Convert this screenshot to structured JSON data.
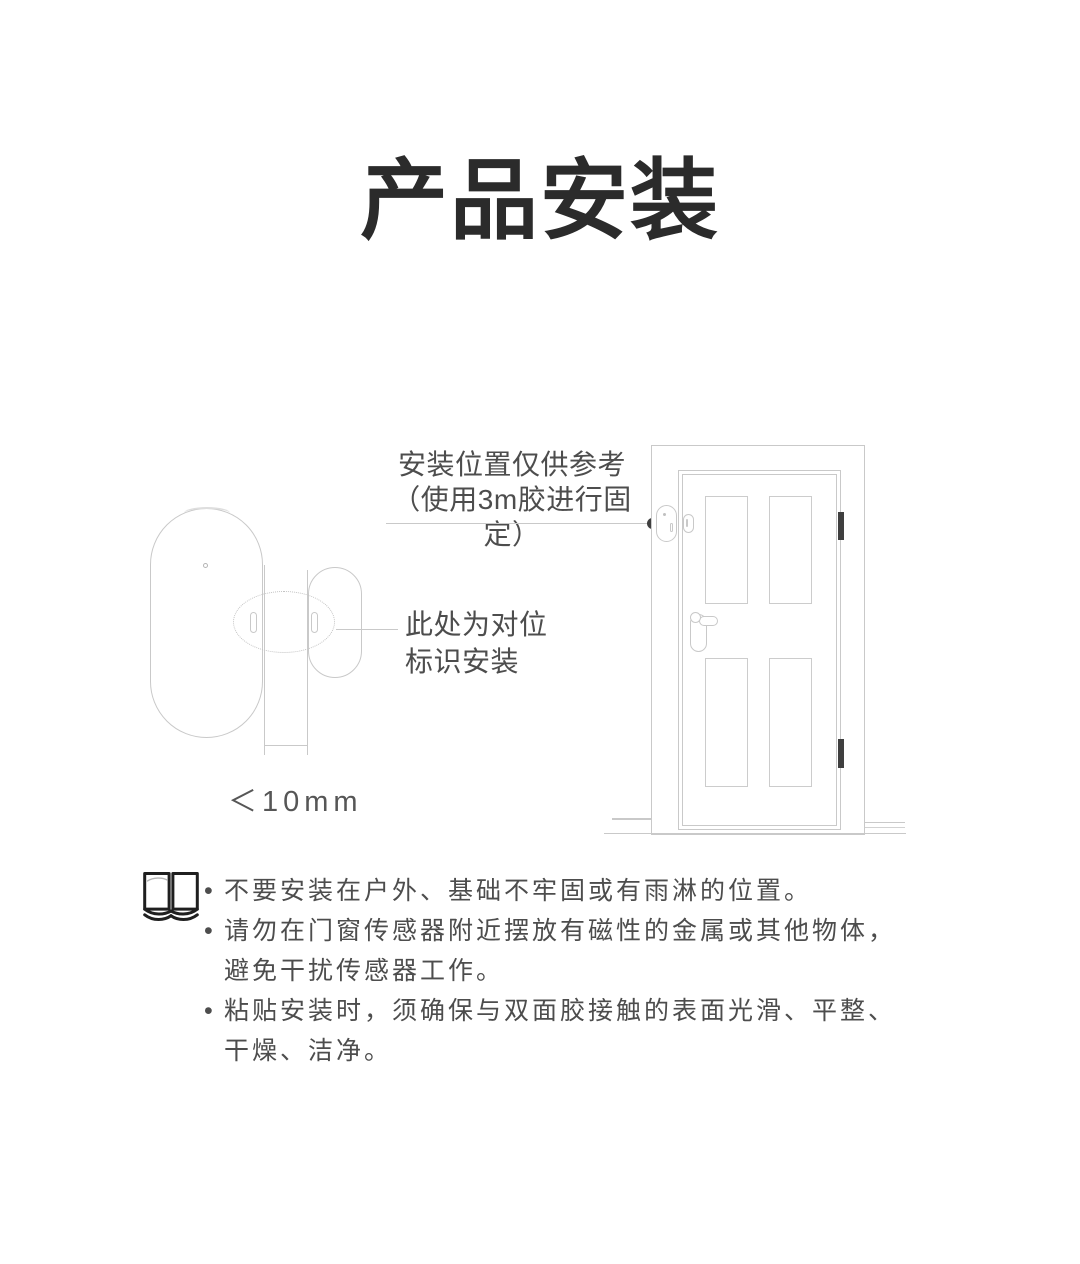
{
  "page": {
    "title": "产品安装"
  },
  "colors": {
    "line_art": "#c9c9c9",
    "text": "#4d4d4d",
    "title": "#2b2b2b",
    "dark_accent": "#3f3f3f"
  },
  "diagram": {
    "gap_label": "＜10mm",
    "annotation_position": {
      "line1": "安装位置仅供参考",
      "line2": "（使用3m胶进行固定）"
    },
    "annotation_alignment": {
      "line1": "此处为对位",
      "line2": "标识安装"
    }
  },
  "notes": {
    "icon": "open-book-icon",
    "bullet": "•",
    "items": [
      {
        "lines": {
          "0": "不要安装在户外、基础不牢固或有雨淋的位置。",
          "1": ""
        }
      },
      {
        "lines": {
          "0": "请勿在门窗传感器附近摆放有磁性的金属或其他物体，",
          "1": "避免干扰传感器工作。"
        }
      },
      {
        "lines": {
          "0": "粘贴安装时，须确保与双面胶接触的表面光滑、平整、",
          "1": "干燥、洁净。"
        }
      }
    ]
  }
}
